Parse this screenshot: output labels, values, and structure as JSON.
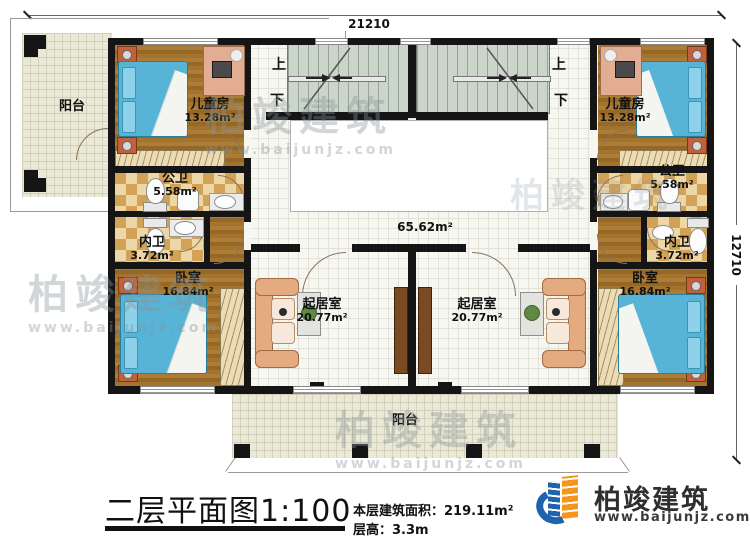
{
  "dimensions": {
    "width_mm": "21210",
    "height_mm": "12710"
  },
  "stairs": {
    "up": "上",
    "down": "下"
  },
  "rooms": {
    "balcony_top_left": {
      "name": "阳台"
    },
    "balcony_bottom": {
      "name": "阳台"
    },
    "kids_room_left": {
      "name": "儿童房",
      "area": "13.28m²"
    },
    "kids_room_right": {
      "name": "儿童房",
      "area": "13.28m²"
    },
    "public_bath_left": {
      "name": "公卫",
      "area": "5.58m²"
    },
    "public_bath_right": {
      "name": "公卫",
      "area": "5.58m²"
    },
    "private_bath_left": {
      "name": "内卫",
      "area": "3.72m²"
    },
    "private_bath_right": {
      "name": "内卫",
      "area": "3.72m²"
    },
    "bedroom_left": {
      "name": "卧室",
      "area": "16.84m²"
    },
    "bedroom_right": {
      "name": "卧室",
      "area": "16.84m²"
    },
    "living_room_left": {
      "name": "起居室",
      "area": "20.77m²"
    },
    "living_room_right": {
      "name": "起居室",
      "area": "20.77m²"
    },
    "hall": {
      "area": "65.62m²"
    }
  },
  "title": {
    "main": "二层平面图",
    "scale": "1:100",
    "floor_area_label": "本层建筑面积：",
    "floor_area_value": "219.11m²",
    "floor_height_label": "层高：",
    "floor_height_value": "3.3m"
  },
  "brand": {
    "name": "柏竣建筑",
    "url": "www.baijunjz.com"
  },
  "watermark": {
    "name": "柏竣建筑",
    "url": "www.baijunjz.com"
  },
  "colors": {
    "wall": "#151515",
    "bed": "#58b4d6",
    "brand_blue": "#1e63ad",
    "brand_orange": "#f7941d"
  }
}
